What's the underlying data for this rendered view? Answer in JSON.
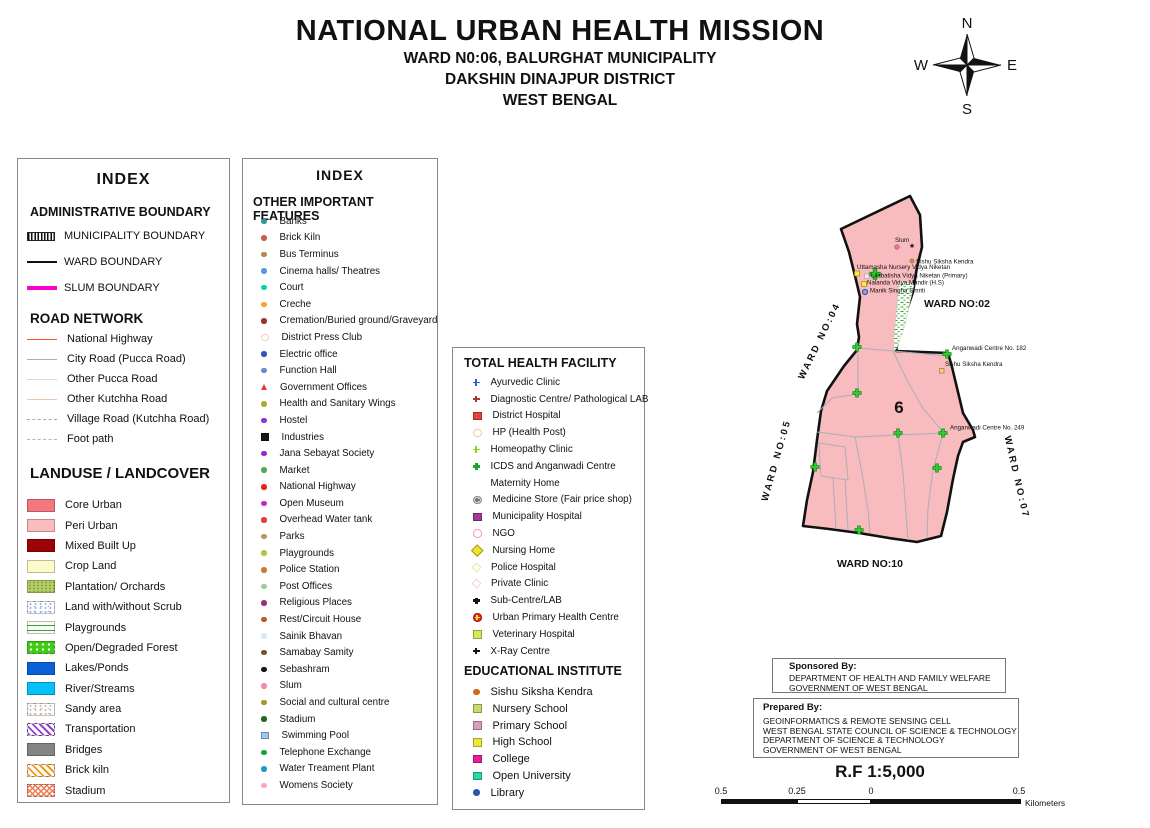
{
  "header": {
    "title": "NATIONAL URBAN HEALTH MISSION",
    "subtitle1": "WARD N0:06,  BALURGHAT MUNICIPALITY",
    "subtitle2": "DAKSHIN DINAJPUR DISTRICT",
    "subtitle3": "WEST BENGAL"
  },
  "compass": {
    "n": "N",
    "e": "E",
    "s": "S",
    "w": "W"
  },
  "index1": {
    "title": "INDEX",
    "admin_title": "ADMINISTRATIVE BOUNDARY",
    "admin_items": [
      {
        "label": "MUNICIPALITY BOUNDARY",
        "swatch": "muni"
      },
      {
        "label": "WARD BOUNDARY",
        "swatch": "wardb"
      },
      {
        "label": "SLUM BOUNDARY",
        "swatch": "slumb",
        "color": "#FF00CC"
      }
    ],
    "road_title": "ROAD NETWORK",
    "road_items": [
      {
        "label": "National Highway",
        "color": "#FF5030",
        "style": "solidline"
      },
      {
        "label": "City Road (Pucca Road)",
        "color": "#ADADAD",
        "style": "solidline"
      },
      {
        "label": "Other Pucca Road",
        "color": "#D9D9D9",
        "style": "solidline"
      },
      {
        "label": "Other Kutchha Road",
        "color": "#F2C4B4",
        "style": "solidline"
      },
      {
        "label": "Village Road (Kutchha Road)",
        "color": "#A8A8A8",
        "style": "dashed"
      },
      {
        "label": "Foot path",
        "color": "#B5B5B5",
        "style": "dashed"
      }
    ],
    "landuse_title": "LANDUSE / LANDCOVER",
    "landuse_items": [
      {
        "label": "Core Urban",
        "color": "#F4777E",
        "pattern": "solid"
      },
      {
        "label": "Peri Urban",
        "color": "#F9BDC0",
        "pattern": "solid"
      },
      {
        "label": "Mixed Built Up",
        "color": "#9C0408",
        "pattern": "solid"
      },
      {
        "label": "Crop Land",
        "color": "#FBFBC9",
        "pattern": "solid"
      },
      {
        "label": "Plantation/ Orchards",
        "color": "#B6CE68",
        "pattern": "plantation"
      },
      {
        "label": "Land with/without Scrub",
        "color": "#92AEE4",
        "pattern": "speckle"
      },
      {
        "label": "Playgrounds",
        "color": "#3F9E3F",
        "pattern": "scribble"
      },
      {
        "label": "Open/Degraded Forest",
        "color": "#3ECC14",
        "pattern": "forest"
      },
      {
        "label": "Lakes/Ponds",
        "color": "#0A60D6",
        "pattern": "solid"
      },
      {
        "label": "River/Streams",
        "color": "#04C2F8",
        "pattern": "solid"
      },
      {
        "label": "Sandy area",
        "color": "#CBB4A2",
        "pattern": "speckle"
      },
      {
        "label": "Transportation",
        "color": "#9340C9",
        "pattern": "hatch"
      },
      {
        "label": "Bridges",
        "color": "#848484",
        "pattern": "solid"
      },
      {
        "label": "Brick kiln",
        "color": "#F29A16",
        "pattern": "hatch"
      },
      {
        "label": "Stadium",
        "color": "#F07B52",
        "pattern": "crosshatch"
      }
    ]
  },
  "index2": {
    "title": "INDEX",
    "section_title": "OTHER IMPORTANT FEATURES",
    "items": [
      {
        "label": "Banks",
        "shape": "dot",
        "color": "#2E9B8F"
      },
      {
        "label": "Brick Kiln",
        "shape": "dot",
        "color": "#C2604A"
      },
      {
        "label": "Bus Terminus",
        "shape": "dot",
        "color": "#B08A50"
      },
      {
        "label": "Cinema halls/ Theatres",
        "shape": "dot",
        "color": "#5599E8"
      },
      {
        "label": "Court",
        "shape": "dot",
        "color": "#00DB99"
      },
      {
        "label": "Creche",
        "shape": "dot",
        "color": "#F5A623"
      },
      {
        "label": "Cremation/Buried ground/Graveyard",
        "shape": "dot",
        "color": "#99322E"
      },
      {
        "label": "District Press Club",
        "shape": "open-circle",
        "color": "#F5C9C9"
      },
      {
        "label": "Electric office",
        "shape": "dot",
        "color": "#3352BB"
      },
      {
        "label": "Function Hall",
        "shape": "dot",
        "color": "#6787CE"
      },
      {
        "label": "Government Offices",
        "shape": "triangle",
        "color": "#E83528"
      },
      {
        "label": "Health and Sanitary Wings",
        "shape": "dot",
        "color": "#ABAB35"
      },
      {
        "label": "Hostel",
        "shape": "dot",
        "color": "#8A35D1"
      },
      {
        "label": "Industries",
        "shape": "square",
        "color": "#161616"
      },
      {
        "label": "Jana Sebayat Society",
        "shape": "dot",
        "color": "#9A27C9"
      },
      {
        "label": "Market",
        "shape": "dot",
        "color": "#57A857"
      },
      {
        "label": "National Highway",
        "shape": "dot",
        "color": "#E82222"
      },
      {
        "label": "Open Museum",
        "shape": "dot",
        "color": "#C926C9"
      },
      {
        "label": "Overhead Water tank",
        "shape": "dot",
        "color": "#E83A3A"
      },
      {
        "label": "Parks",
        "shape": "dot",
        "color": "#BB9663"
      },
      {
        "label": "Playgrounds",
        "shape": "dot",
        "color": "#A9C94A"
      },
      {
        "label": "Police Station",
        "shape": "dot",
        "color": "#C97A35"
      },
      {
        "label": "Post Offices",
        "shape": "dot",
        "color": "#9CCB9C"
      },
      {
        "label": "Religious Places",
        "shape": "dot",
        "color": "#973373"
      },
      {
        "label": "Rest/Circuit House",
        "shape": "dot",
        "color": "#BB5A26"
      },
      {
        "label": "Sainik Bhavan",
        "shape": "dot",
        "color": "#D8E8F5"
      },
      {
        "label": "Samabay Samity",
        "shape": "dot",
        "color": "#6B5A26"
      },
      {
        "label": "Sebashram",
        "shape": "dot",
        "color": "#161616"
      },
      {
        "label": "Slum",
        "shape": "dot",
        "color": "#F28CA8"
      },
      {
        "label": "Social and cultural centre",
        "shape": "dot",
        "color": "#9A9A26"
      },
      {
        "label": "Stadium",
        "shape": "dot",
        "color": "#266326"
      },
      {
        "label": "Swimming Pool",
        "shape": "square",
        "color": "#9CC9F2"
      },
      {
        "label": "Telephone Exchange",
        "shape": "dot",
        "color": "#0AA83A"
      },
      {
        "label": "Water Treament Plant",
        "shape": "dot",
        "color": "#2697BB"
      },
      {
        "label": "Womens Society",
        "shape": "dot",
        "color": "#F5A8C9"
      }
    ]
  },
  "health": {
    "title": "TOTAL HEALTH FACILITY",
    "items": [
      {
        "label": "Ayurvedic Clinic",
        "shape": "plus",
        "color": "#2B5FD9"
      },
      {
        "label": "Diagnostic Centre/ Pathological LAB",
        "shape": "plus",
        "color": "#A03A2A"
      },
      {
        "label": "District Hospital",
        "shape": "square",
        "color": "#E8403A"
      },
      {
        "label": "HP (Health Post)",
        "shape": "open-circle",
        "color": "#F2C9A0"
      },
      {
        "label": "Homeopathy Clinic",
        "shape": "plus",
        "color": "#8CD61E"
      },
      {
        "label": "ICDS and Anganwadi Centre",
        "shape": "cross",
        "color": "#1FA42B"
      },
      {
        "label": "Maternity Home",
        "shape": "none",
        "color": "#ffffff"
      },
      {
        "label": "Medicine Store (Fair price shop)",
        "shape": "circle-plus",
        "color": "#CFCFCF",
        "color2": "#777777"
      },
      {
        "label": "Municipality Hospital",
        "shape": "square",
        "color": "#A13C96"
      },
      {
        "label": "NGO",
        "shape": "open-circle",
        "color": "#F79BA0"
      },
      {
        "label": "Nursing Home",
        "shape": "diamond",
        "color": "#EFE32B"
      },
      {
        "label": "Police Hospital",
        "shape": "open-diamond",
        "color": "#D7EFA5"
      },
      {
        "label": "Private Clinic",
        "shape": "open-diamond",
        "color": "#F8CFD4"
      },
      {
        "label": "Sub-Centre/LAB",
        "shape": "cross",
        "color": "#141414"
      },
      {
        "label": "Urban Primary Health Centre",
        "shape": "circle-plus",
        "color": "#E8241E",
        "color2": "#F7E72B"
      },
      {
        "label": "Veterinary Hospital",
        "shape": "square",
        "color": "#D3E955"
      },
      {
        "label": "X-Ray Centre",
        "shape": "plus",
        "color": "#141414"
      }
    ],
    "edu_title": "EDUCATIONAL INSTITUTE",
    "edu_items": [
      {
        "label": "Sishu Siksha Kendra",
        "shape": "dot",
        "color": "#D2691E"
      },
      {
        "label": "Nursery School",
        "shape": "square",
        "color": "#CBD96A"
      },
      {
        "label": "Primary School",
        "shape": "square",
        "color": "#DC9CBE"
      },
      {
        "label": "High School",
        "shape": "square",
        "color": "#EDE93A"
      },
      {
        "label": "College",
        "shape": "square",
        "color": "#EA1E96"
      },
      {
        "label": "Open University",
        "shape": "square",
        "color": "#2BD9A8"
      },
      {
        "label": "Library",
        "shape": "dot",
        "color": "#2A57A8"
      }
    ]
  },
  "map": {
    "ward_number": "6",
    "fill_color": "#F8BCBE",
    "ward02": "WARD NO:02",
    "ward04": "WARD NO:04",
    "ward05": "WARD NO:05",
    "ward07": "WARD NO:07",
    "ward10": "WARD NO:10",
    "slum_label": "Slum",
    "sishu1": "Sishu Siksha Kendra",
    "uttamasha": "Uttamasha Nursery Vidya Niketan",
    "lilabatisha": "Lilabatisha Vidya Niketan (Primary)",
    "nalanda": "Nalanda Vidya Mandir (H.S)",
    "manik": "Manik Singha Smriti",
    "anganwadi182": "Anganwadi Centre No. 182",
    "sishu2": "Sishu Siksha Kendra",
    "anganwadi249": "Anganwadi Centre No. 249"
  },
  "footer": {
    "sponsored_title": "Sponsored By:",
    "sponsored_lines_1": "DEPARTMENT OF HEALTH AND FAMILY WELFARE",
    "sponsored_lines_2": "GOVERNMENT OF WEST BENGAL",
    "prepared_title": "Prepared By:",
    "prepared_lines_1": "GEOINFORMATICS & REMOTE SENSING CELL",
    "prepared_lines_2": "WEST BENGAL STATE COUNCIL OF SCIENCE & TECHNOLOGY",
    "prepared_lines_3": "DEPARTMENT OF SCIENCE & TECHNOLOGY",
    "prepared_lines_4": "GOVERNMENT OF WEST BENGAL",
    "scale_rf": "R.F 1:5,000",
    "scale_labels": [
      "0.5",
      "0.25",
      "0",
      "0.5"
    ],
    "scale_unit": "Kilometers"
  }
}
